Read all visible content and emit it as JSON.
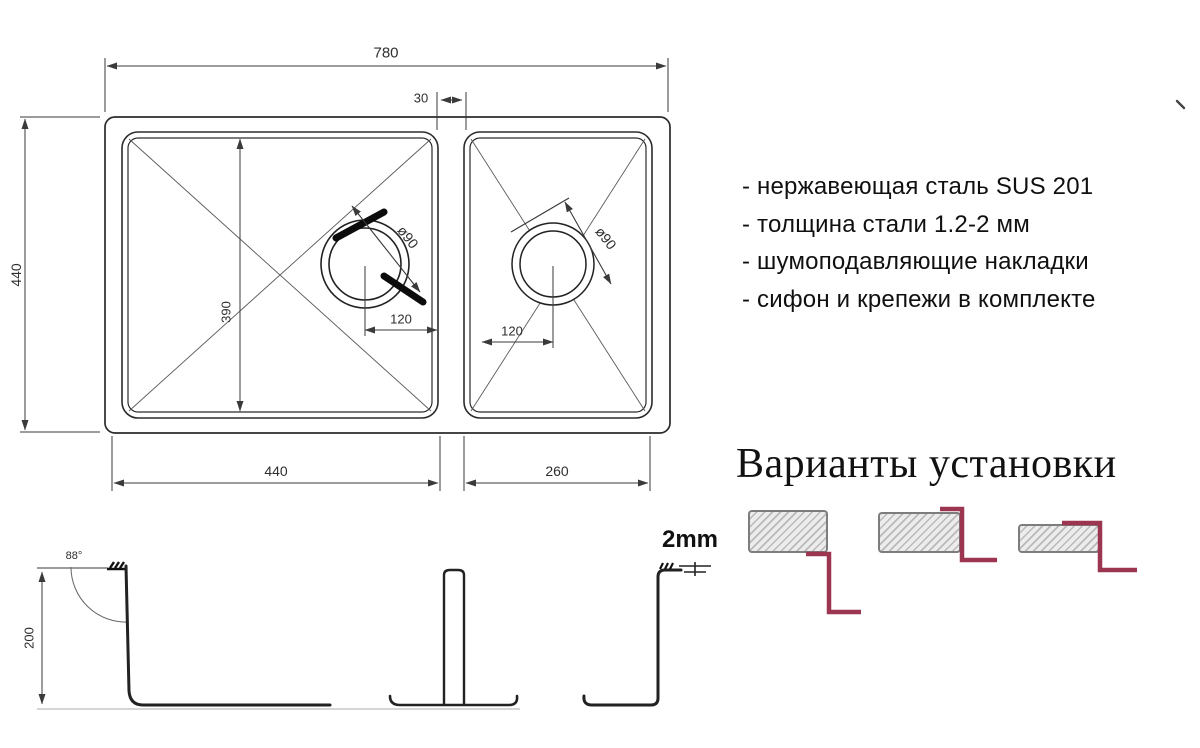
{
  "drawing_title": "double-bowl sink technical drawing",
  "plan_view": {
    "dim_overall_width": "780",
    "dim_divider_width": "30",
    "dim_overall_depth": "440",
    "dim_bowl_inner_depth": "390",
    "dim_left_drain_offset": "120",
    "dim_right_drain_offset": "120",
    "dim_left_drain_diameter": "ø90",
    "dim_right_drain_diameter": "ø90",
    "dim_left_bowl_width": "440",
    "dim_right_bowl_width": "260"
  },
  "side_view": {
    "dim_bowl_depth": "200",
    "dim_wall_angle": "88°",
    "dim_rim_thickness": "2mm"
  },
  "specs": {
    "items": [
      "- нержавеющая сталь SUS 201",
      "- толщина стали 1.2-2 мм",
      "- шумоподавляющие накладки",
      "- сифон и крепежи в комплекте"
    ]
  },
  "installation": {
    "heading": "Варианты установки",
    "options_count": 3
  },
  "colors": {
    "accent_red": "#9c3550",
    "line_dark": "#222222",
    "dimension_line": "#3a3a3a",
    "hatch_gray": "#b9b9b9",
    "counter_border": "#7d7d7d"
  }
}
